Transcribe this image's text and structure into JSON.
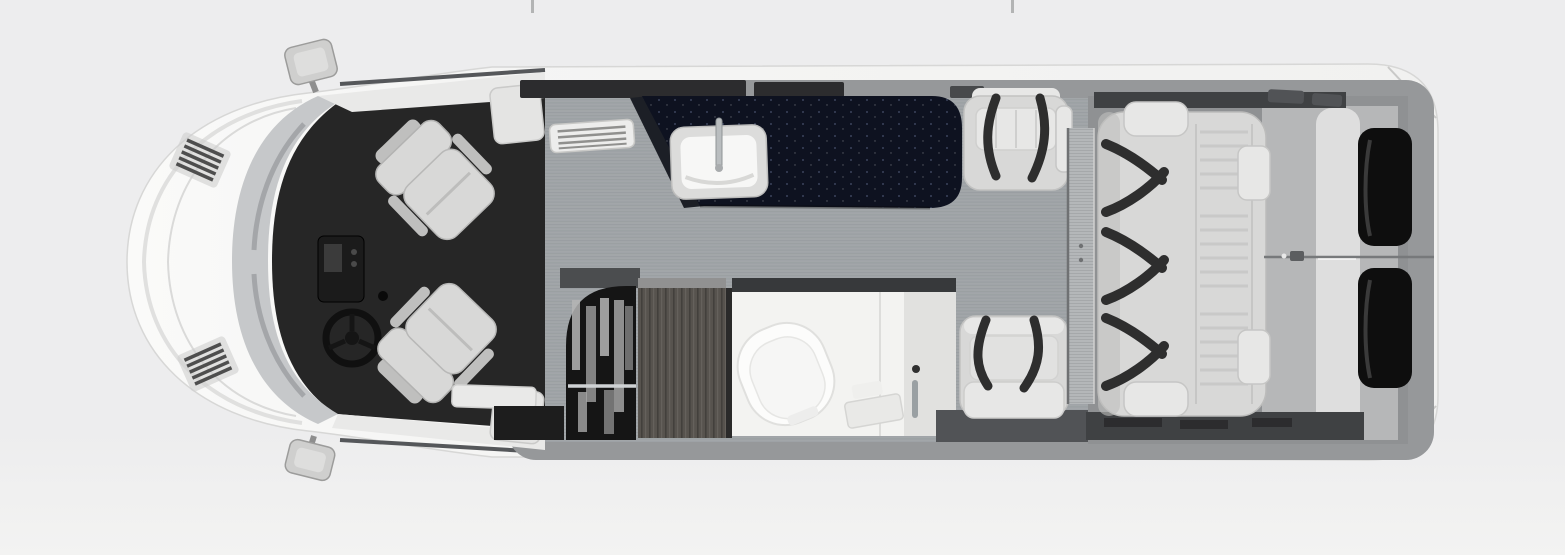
{
  "scene": {
    "description": "Top-down 3D rendered floor plan of a Class B camper van shown in a photo carousel",
    "text_content": "none - image contains no visible text",
    "carousel_ticks": {
      "left_x_px": 531,
      "right_x_px": 1011
    }
  },
  "theme": {
    "bg": "#ededee",
    "bg2": "#f3f3f2",
    "tick": "#b3b4b4",
    "tickLeftX": "531px",
    "tickRightX": "1011px",
    "shell": "#f6f6f5",
    "shellEdge": "#d7d7d6",
    "wall": "#96989a",
    "wallDark": "#6f7173",
    "floor": "#a2a6a9",
    "floorStripe": "#91969a",
    "cabFloor": "#262626",
    "trim": "#e9e9e8",
    "glass": "#c6c8ca",
    "glassStreak": "#9b9da0",
    "dash": "#1b1b1b",
    "seat": "#d8d8d7",
    "seatShade": "#bfbfbe",
    "seatLight": "#e7e7e6",
    "belt": "#2e2e2e",
    "counter": "#0e1220",
    "counterFleck": "#8fa0c8",
    "sinkRim": "#dcdcdb",
    "sinkBowl": "#f7f7f6",
    "chrome": "#b9bdbf",
    "closet": "#151515",
    "rod": "#cfd2d4",
    "wood": "#57534e",
    "woodDark": "#403d39",
    "woodLight": "#6b6762",
    "bath": "#f3f3f1",
    "bathShade": "#e1e1df",
    "bathBand": "#37393b",
    "panel": "#b4b7b9",
    "panelStripe": "#a5a8aa",
    "rearFloor": "#8f9193",
    "platform": "#b6b7b8",
    "bedBand": "#dedede",
    "windowGlass": "#0e0e0e",
    "darkStrip": "#3f4143",
    "stepWell": "#1d1d1d"
  },
  "parts": [
    "camper-van-floorplan",
    "front-bumper",
    "hood",
    "hood-vents",
    "windshield",
    "wiper-streaks",
    "side-mirror-top",
    "side-mirror-bottom",
    "dashboard",
    "steering-wheel",
    "driver-seat",
    "passenger-seat",
    "cab-trim",
    "entry-step",
    "step-well",
    "galley-counter",
    "counter-flip-panel",
    "kitchen-sink",
    "faucet",
    "vent-grille",
    "window-strip",
    "wardrobe",
    "clothes",
    "clothes-rod",
    "wood-cabinet",
    "bathroom",
    "toilet",
    "shower-head",
    "shower-rail",
    "shower-shelf",
    "dinette-seat-front",
    "dinette-seat-rear",
    "seatbelt-straps",
    "divider-panel",
    "rear-sofa",
    "sofa-armrest-top",
    "sofa-armrest-bottom",
    "sofa-headrests",
    "sofa-seatbelts",
    "rear-bed-platform",
    "rear-door-seam",
    "door-latch",
    "rear-window-upper",
    "rear-window-lower",
    "corner-sparkle"
  ]
}
